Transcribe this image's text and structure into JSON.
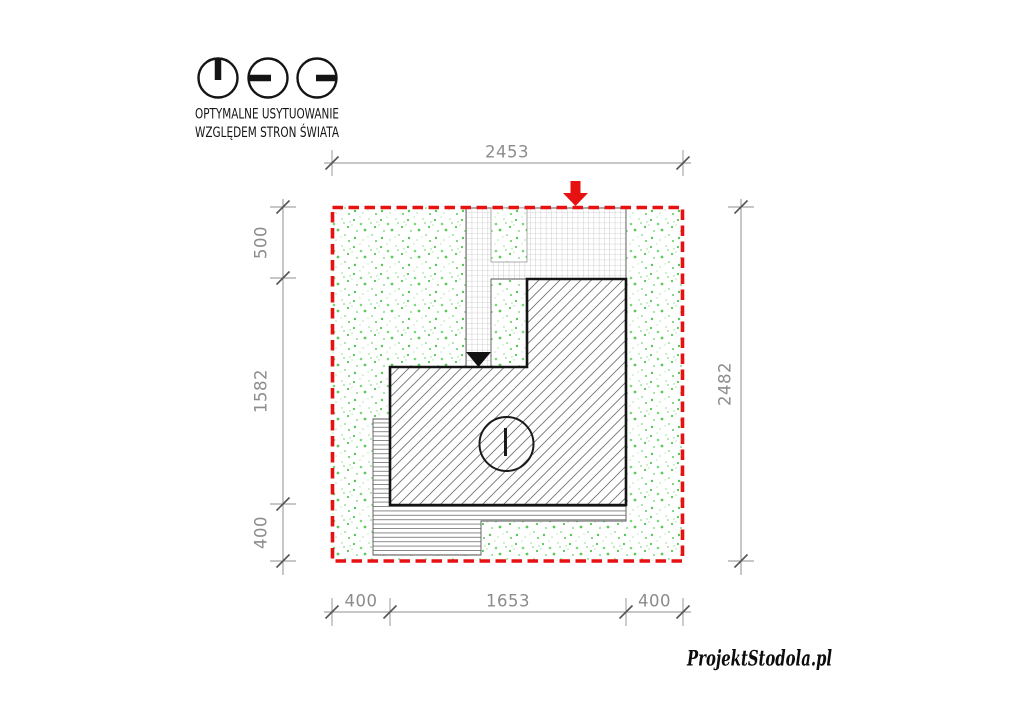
{
  "legend": {
    "caption_line1": "OPTYMALNE USYTUOWANIE",
    "caption_line2": "WZGLĘDEM STRON ŚWIATA",
    "icons": [
      {
        "name": "sun-clock-noon-icon"
      },
      {
        "name": "sun-clock-west-icon"
      },
      {
        "name": "sun-clock-east-icon"
      }
    ]
  },
  "dimensions": {
    "top_total": "2453",
    "right_total": "2482",
    "left_segments": [
      "500",
      "1582",
      "400"
    ],
    "bottom_segments": [
      "400",
      "1653",
      "400"
    ]
  },
  "plan": {
    "boundary_style": "red-dashed-plot-line",
    "textures": {
      "lawn": "green-speckle",
      "driveway": "paver-grid",
      "house": "diagonal-hatch",
      "terrace": "deck-stripes"
    }
  },
  "watermark": "ProjektStodola.pl",
  "colors": {
    "boundary_red": "#e81111",
    "arrow_red": "#e81111",
    "grass_green": "#53c653",
    "dimension_gray": "#8c8c8c",
    "drawing_black": "#141414"
  }
}
